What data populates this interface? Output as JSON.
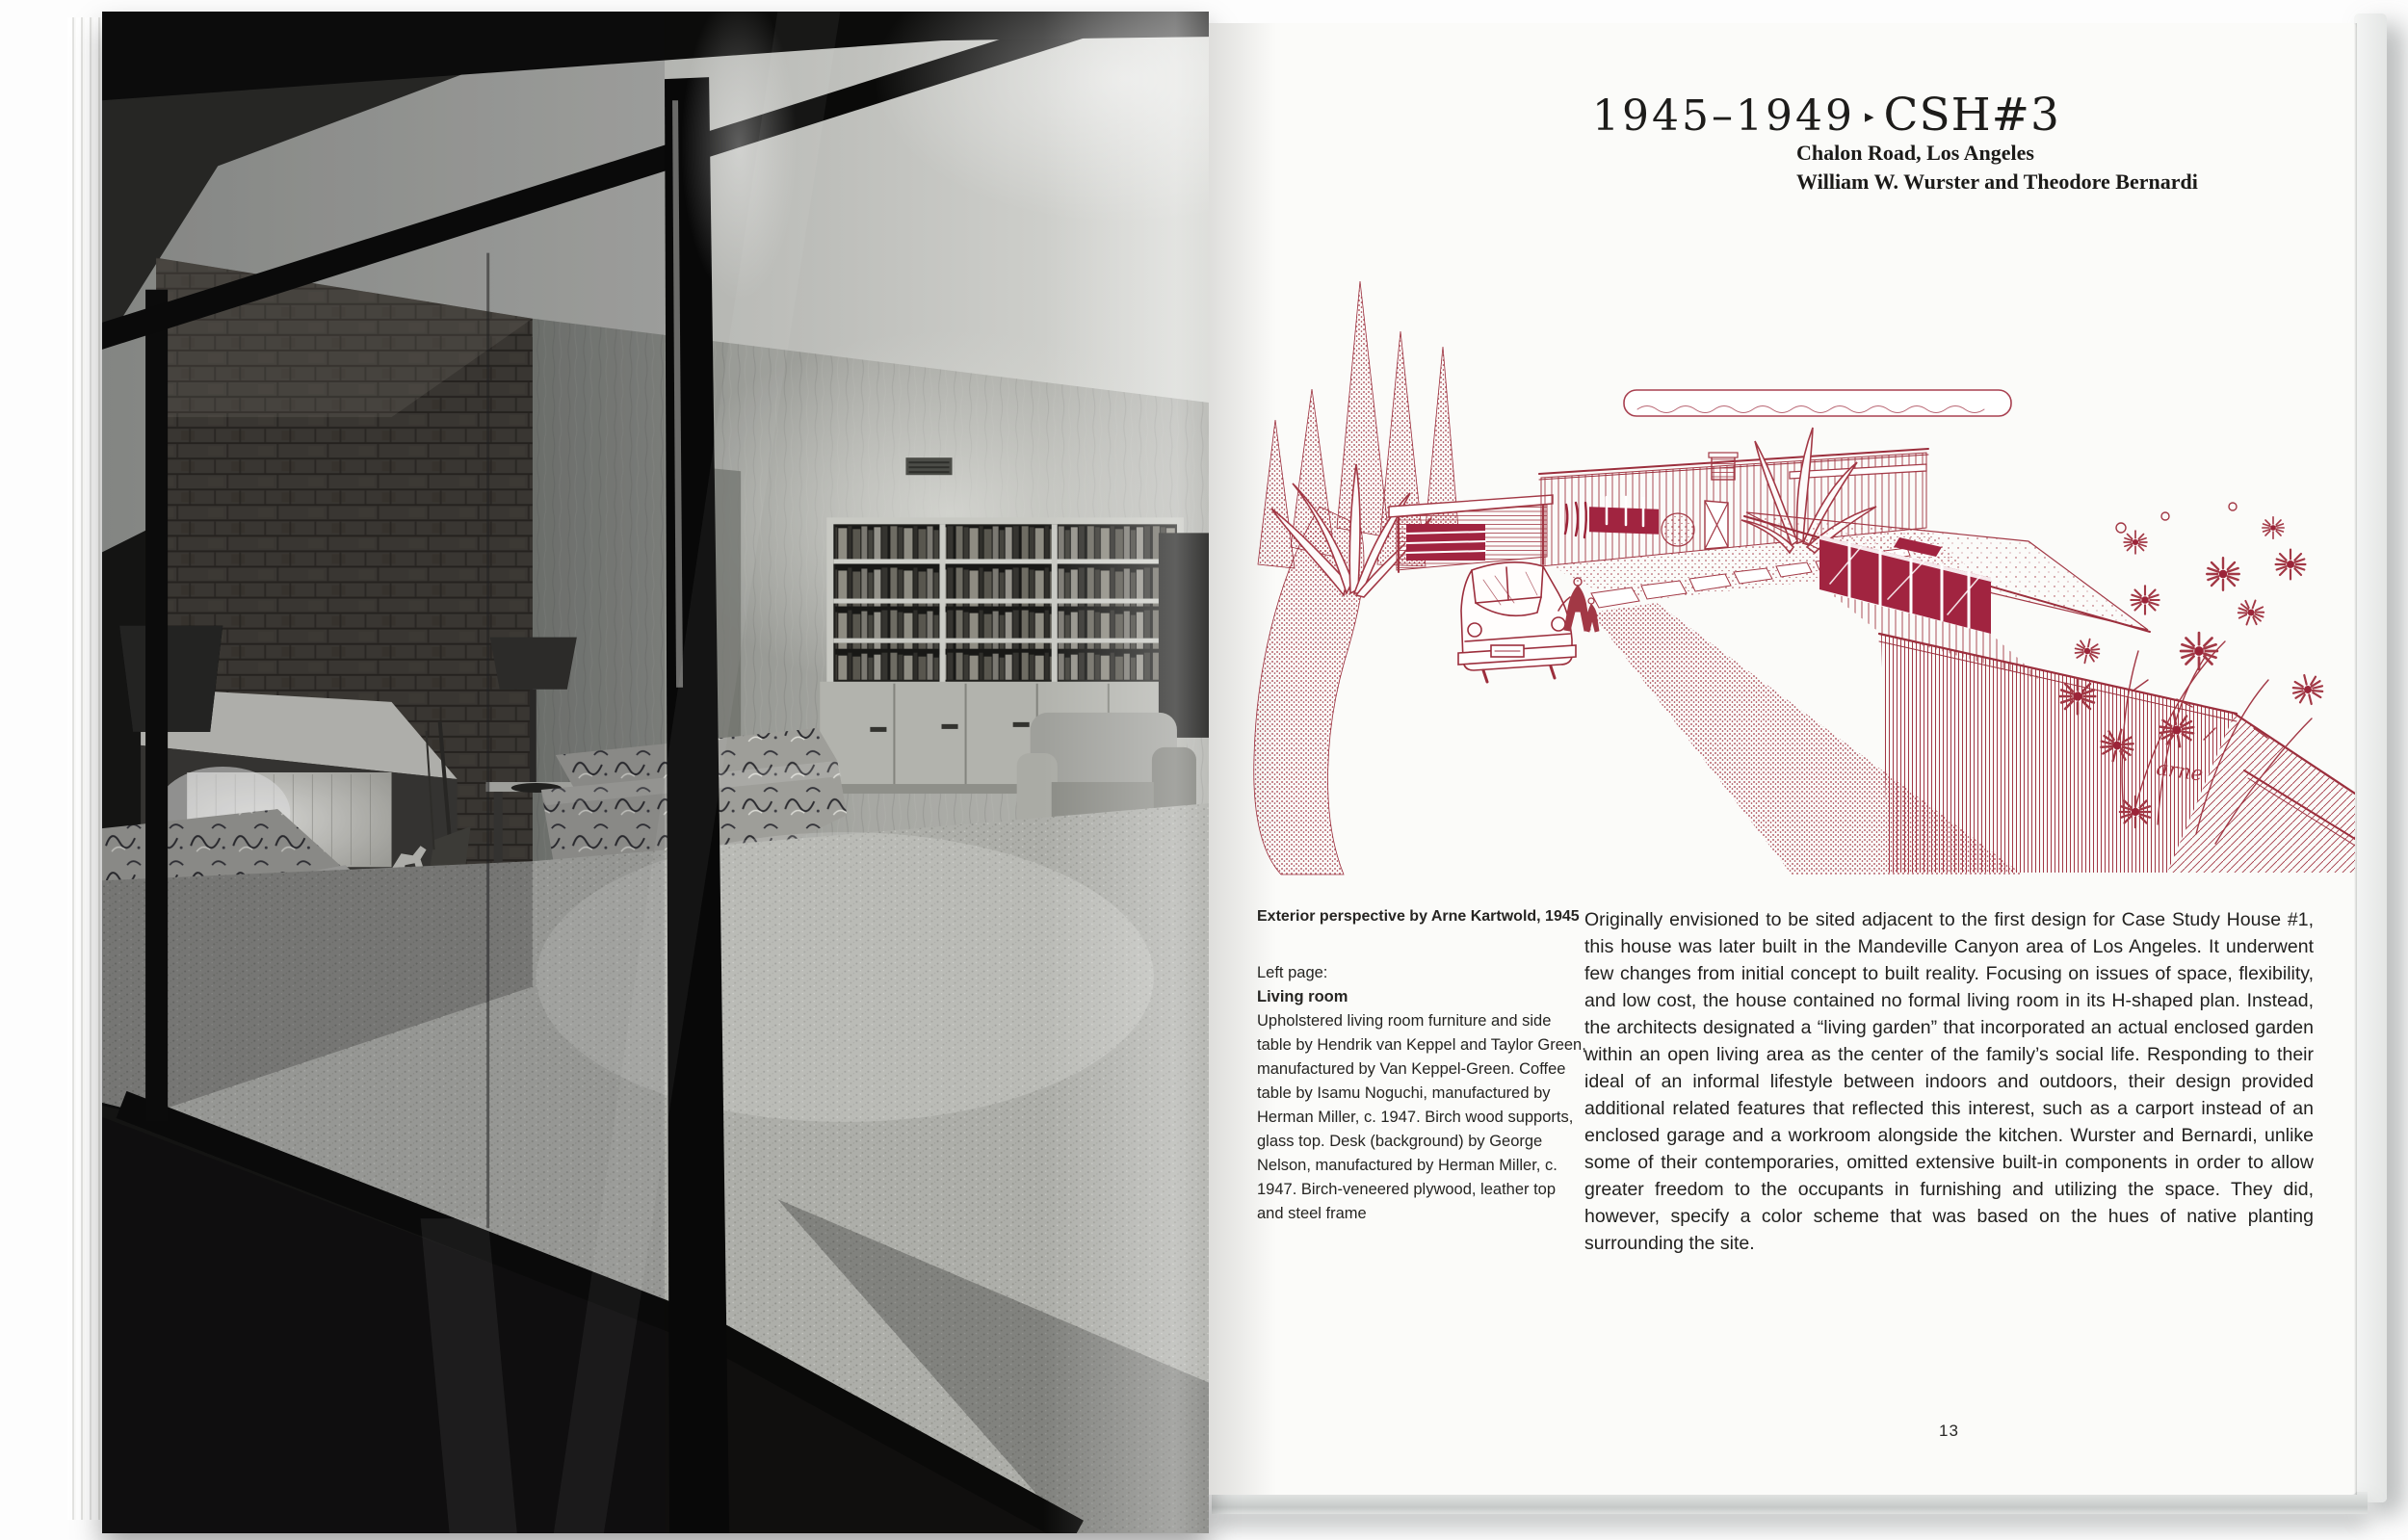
{
  "book": {
    "right_page": {
      "header": {
        "years": "1945–1949",
        "separator": "▸",
        "house": "CSH#3",
        "address": "Chalon Road, Los Angeles",
        "architects": "William W. Wurster and Theodore Bernardi"
      },
      "illustration": {
        "signature": "arne",
        "ink_color": "#a23845"
      },
      "caption": {
        "credit": "Exterior perspective by Arne Kartwold, 1945",
        "left_page_label": "Left page:",
        "left_page_title": "Living room",
        "left_page_text": "Upholstered living room furniture and side table by Hendrik van Keppel and Taylor Green, manufactured by Van Keppel-Green. Coffee table by Isamu Noguchi, manufactured by Herman Miller, c. 1947. Birch wood supports, glass top. Desk (background) by George Nelson, manufactured by Herman Miller, c. 1947. Birch-veneered plywood, leather top and steel frame"
      },
      "body_text": "Originally envisioned to be sited adjacent to the first design for Case Study House #1, this house was later built in the Mandeville Canyon area of Los Angeles. It underwent few changes from initial concept to built reality. Focusing on issues of space, flexibility, and low cost, the house contained no formal living room in its H-shaped plan. Instead, the architects designated a “living garden” that incorporated an actual enclosed garden within an open living area as the center of the family’s social life. Responding to their ideal of an informal lifestyle between indoors and outdoors, their design provided additional related features that reflected this interest, such as a carport instead of an enclosed garage and a workroom alongside the kitchen. Wurster and Bernardi, unlike some of their contemporaries, omitted extensive built-in components in order to allow greater freedom to the occupants in furnishing and utilizing the space. They did, however, specify a color scheme that was based on the hues of native planting surrounding the site.",
      "page_number": "13"
    },
    "colors": {
      "ink_red": "#a23845",
      "window_red": "#a12440",
      "paper": "#fbfbf9",
      "photo_black": "#0b0b0a"
    }
  }
}
